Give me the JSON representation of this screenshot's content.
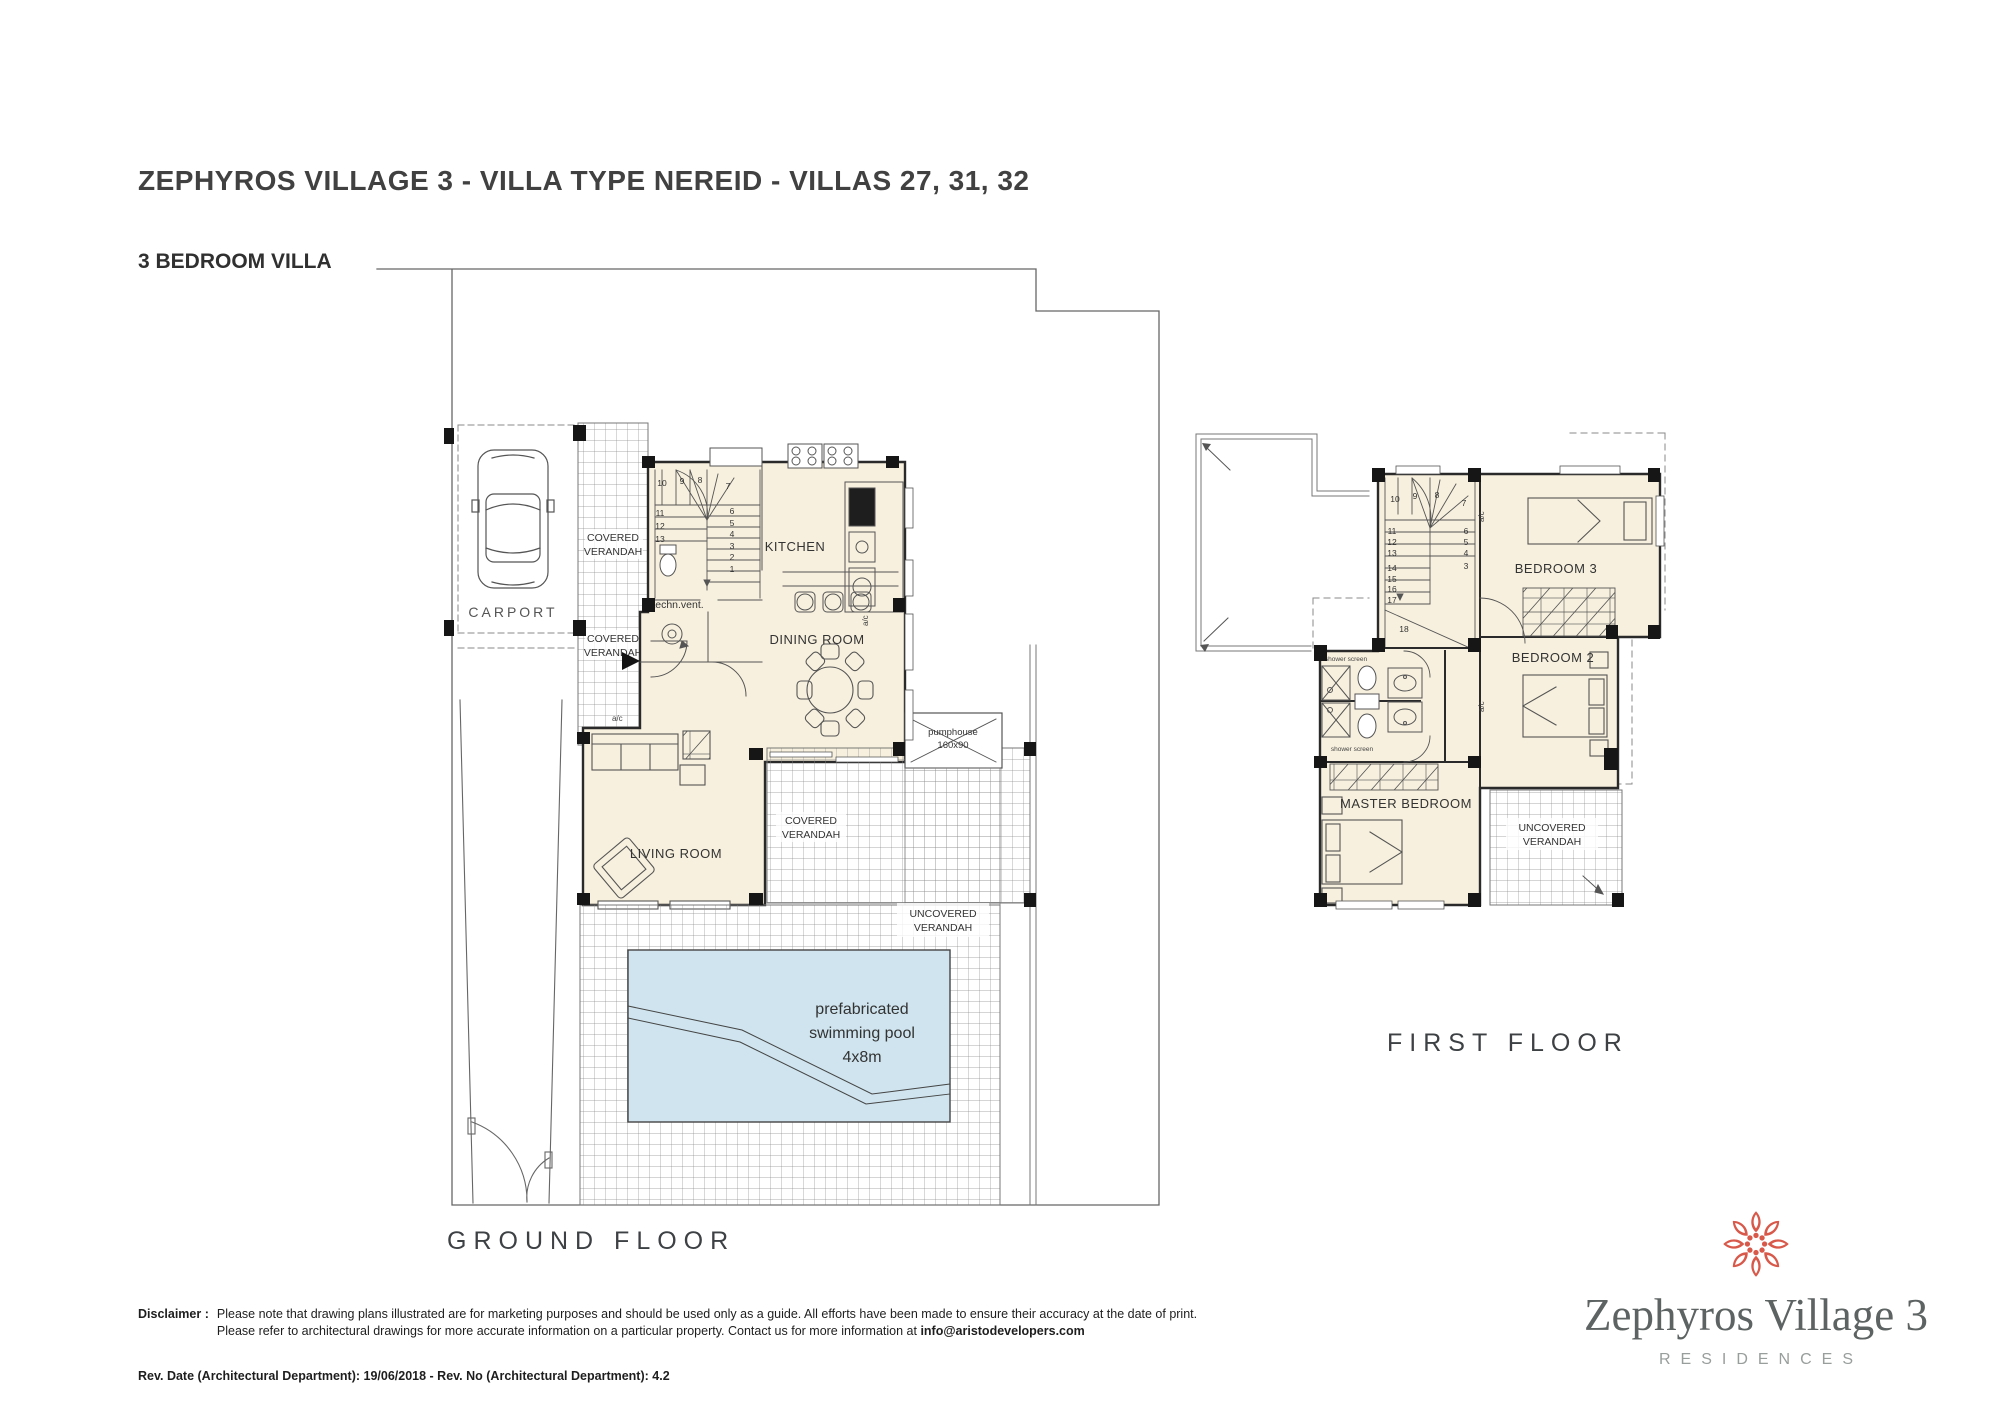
{
  "header": {
    "title": "ZEPHYROS VILLAGE 3 - VILLA TYPE NEREID - VILLAS 27, 31, 32",
    "subtitle": "3 BEDROOM VILLA"
  },
  "ground_floor": {
    "caption": "GROUND FLOOR",
    "labels": {
      "carport": "CARPORT",
      "kitchen": "KITCHEN",
      "dining_room": "DINING ROOM",
      "living_room": "LIVING ROOM",
      "techn_vent": "techn.vent.",
      "covered_verandah": [
        "COVERED",
        "VERANDAH"
      ],
      "uncovered_verandah": [
        "UNCOVERED",
        "VERANDAH"
      ],
      "pumphouse": [
        "pumphouse",
        "160x90"
      ],
      "pool": [
        "prefabricated",
        "swimming pool",
        "4x8m"
      ],
      "ac": "a/c"
    },
    "stairs": {
      "top": [
        "10",
        "9",
        "8",
        "7"
      ],
      "left": [
        "11",
        "12",
        "13"
      ],
      "right": [
        "6",
        "5",
        "4",
        "3",
        "2",
        "1"
      ]
    }
  },
  "first_floor": {
    "caption": "FIRST FLOOR",
    "labels": {
      "bedroom3": "BEDROOM 3",
      "bedroom2": "BEDROOM 2",
      "master_bedroom": "MASTER BEDROOM",
      "uncovered_verandah": [
        "UNCOVERED",
        "VERANDAH"
      ],
      "shower_screen": "shower screen",
      "ac": "a/c"
    },
    "stairs": {
      "top": [
        "10",
        "9",
        "8",
        "7"
      ],
      "left": [
        "11",
        "12",
        "13",
        "14",
        "15",
        "16",
        "17"
      ],
      "right": [
        "6",
        "5",
        "4",
        "3"
      ],
      "bottom": "18"
    }
  },
  "footer": {
    "disclaimer_label": "Disclaimer :",
    "disclaimer_line1": "Please note that drawing plans illustrated are for marketing purposes and should be used only as a guide. All efforts have been made to ensure their accuracy at the date of print.",
    "disclaimer_line2": "Please refer to architectural drawings for more accurate information on a particular property. Contact us for more information at ",
    "disclaimer_email": "info@aristodevelopers.com",
    "revision": "Rev. Date (Architectural Department): 19/06/2018 - Rev. No (Architectural Department): 4.2"
  },
  "logo": {
    "name": "Zephyros Village 3",
    "tagline": "RESIDENCES",
    "accent_color": "#d8584a"
  },
  "colors": {
    "room_fill": "#f7f0de",
    "pool_fill": "#cfe4ee",
    "wall": "#1c1c1c",
    "line": "#5a5a5a"
  }
}
